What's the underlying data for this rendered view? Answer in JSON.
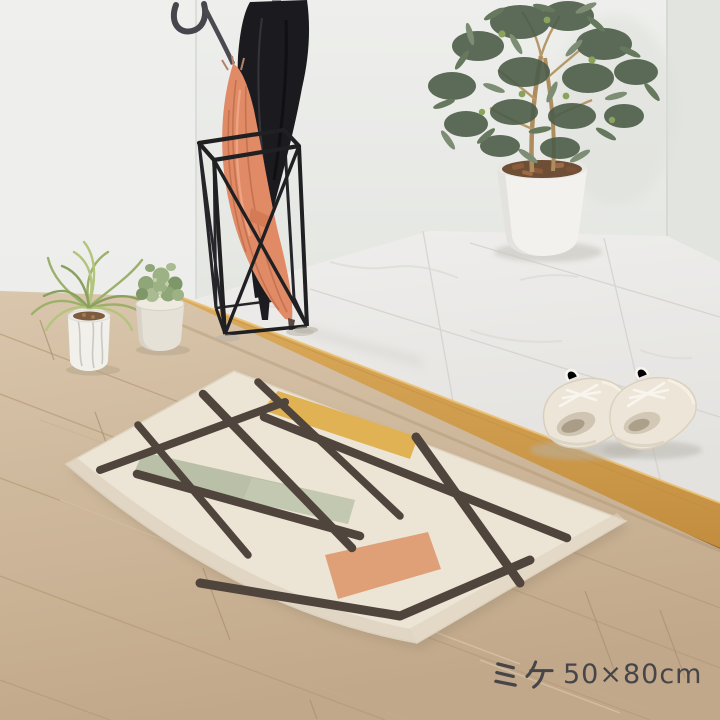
{
  "caption": {
    "name_kana": "ミケ",
    "size_label": "50×80cm",
    "full_text": "ミケ 50×80cm"
  },
  "palette": {
    "wall": "#ebecea",
    "marble_light": "#efeeec",
    "marble_dark": "#e3e2df",
    "strip_light": "#dcab5c",
    "strip_dark": "#c28d3e",
    "wood_light": "#d9c6ac",
    "wood_dark": "#c2a88a",
    "rug_base": "#ece4d4",
    "rug_line": "#50453c",
    "rug_yellow": "#e0b254",
    "rug_green": "#b7bda4",
    "rug_orange": "#dfa077",
    "umbrella_coral": "#e08a66",
    "umbrella_black": "#1b1b1f",
    "stand_black": "#202023",
    "pot_white": "#f2f1ed",
    "shoe_cream": "#ede6d8",
    "foliage_dark": "#53634d",
    "caption_color": "#46464a"
  }
}
